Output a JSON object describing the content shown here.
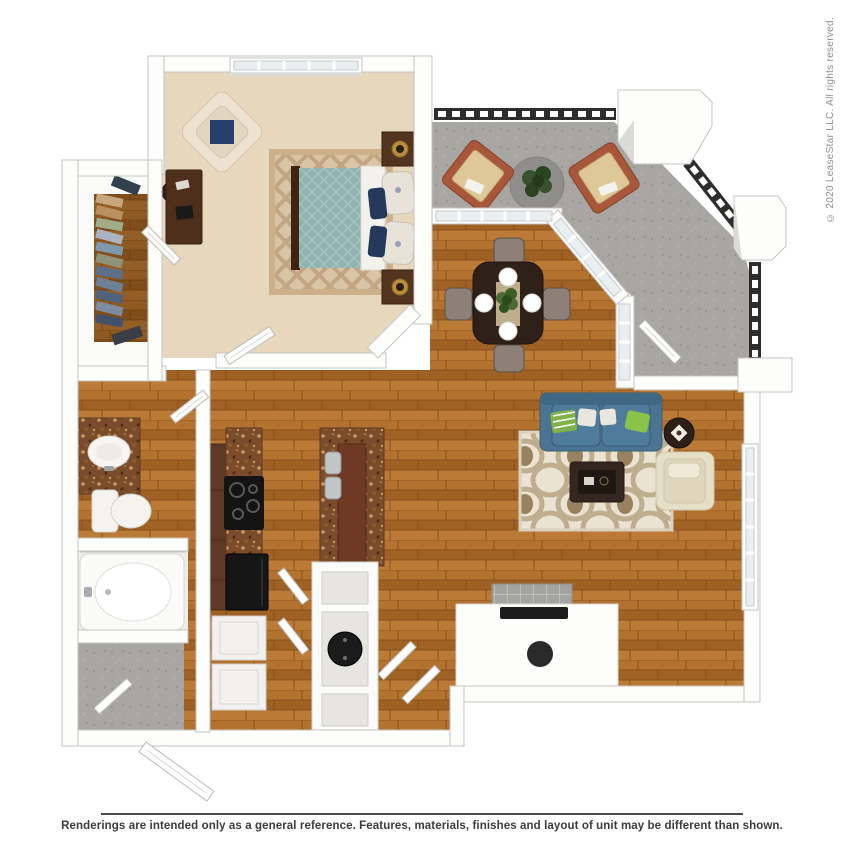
{
  "watermark": {
    "text": "© 2020 LeaseStar LLC. All rights reserved."
  },
  "footer": {
    "disclaimer": "Renderings are intended only as a general reference. Features, materials, finishes and layout of unit may be different than shown."
  },
  "floorplan": {
    "type": "3d-rendered-floor-plan",
    "unit": "one-bedroom one-bath apartment with patio",
    "rooms": [
      {
        "name": "bedroom",
        "floor": "beige-carpet",
        "furniture": [
          "window",
          "accent-armchair-with-navy-pillow",
          "desk",
          "desk-chair",
          "trellis-area-rug",
          "queen-bed-teal-duvet",
          "nightstand-x2",
          "table-lamp-x2"
        ]
      },
      {
        "name": "walk-in-closet",
        "floor": "wood",
        "furniture": [
          "hanging-clothes-rod"
        ]
      },
      {
        "name": "bathroom",
        "floor": "wood",
        "furniture": [
          "granite-vanity",
          "oval-sink",
          "vanity-lights",
          "toilet",
          "oval-bathtub",
          "shower-rod"
        ]
      },
      {
        "name": "kitchen",
        "floor": "wood",
        "furniture": [
          "granite-counter",
          "range-cooktop",
          "refrigerator",
          "island-with-sink",
          "breakfast-bar",
          "washer-dryer-stack",
          "pantry-shelves",
          "water-heater",
          "linen-closet"
        ]
      },
      {
        "name": "dining-area",
        "floor": "wood",
        "furniture": [
          "bay-windows",
          "dining-table",
          "dining-chair-x4",
          "place-setting-x4",
          "centerpiece-plant"
        ]
      },
      {
        "name": "living-room",
        "floor": "wood",
        "furniture": [
          "blue-sofa",
          "throw-pillows",
          "ogee-area-rug",
          "coffee-table",
          "cream-accent-chair",
          "round-side-table",
          "media-console",
          "tv",
          "tall-window"
        ]
      },
      {
        "name": "patio",
        "floor": "concrete",
        "furniture": [
          "railing",
          "corner-column-x3",
          "lounge-chair-x2",
          "round-outdoor-rug",
          "potted-plant",
          "patio-door"
        ]
      },
      {
        "name": "entry",
        "floor": "concrete",
        "furniture": [
          "entry-door"
        ]
      }
    ],
    "palette": {
      "wall": "#fdfdfc",
      "wall_edge": "#c6c4c0",
      "wood_floor": "#ad6c2c",
      "carpet": "#e6d7bd",
      "concrete": "#a7a6a2",
      "granite": "#7a4c2b",
      "cabinet_wood": "#5e3a26",
      "bed_duvet": "#8fb3b0",
      "sofa_blue": "#4a7492",
      "accent_green": "#7fb347",
      "accent_navy": "#24395c",
      "rug_living": "#ebe3d2",
      "rug_bedroom": "#d9c5a5",
      "railing_dark": "#2e2d2b",
      "patio_chair_frame": "#a8573a",
      "patio_cushion": "#dfc897",
      "espresso_table": "#2f2119",
      "cream_chair": "#e6dfc8"
    }
  }
}
